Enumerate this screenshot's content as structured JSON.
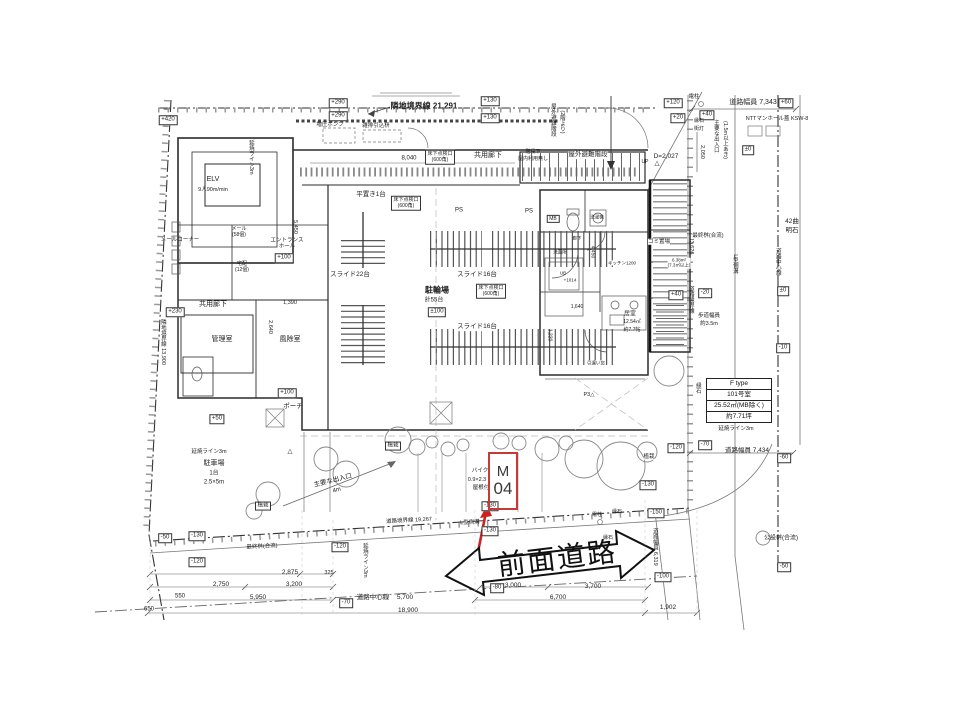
{
  "colors": {
    "marker_red": "#c73a34",
    "arrow_red": "#cc2222",
    "line_dark": "#2b2b2b"
  },
  "marker": {
    "line1": "M",
    "line2": "04"
  },
  "road": {
    "label": "前面道路"
  },
  "unit_info": {
    "rows": [
      "F type",
      "101号室",
      "25.52㎡(MB除く)",
      "約7.71坪"
    ]
  },
  "annotations": [
    {
      "t": "+420",
      "x": 168,
      "y": 120,
      "b": 1
    },
    {
      "t": "+290",
      "x": 338,
      "y": 103,
      "b": 1
    },
    {
      "t": "+290",
      "x": 338,
      "y": 116,
      "b": 1
    },
    {
      "t": "+130",
      "x": 490,
      "y": 101,
      "b": 1
    },
    {
      "t": "+130",
      "x": 490,
      "y": 118,
      "b": 1
    },
    {
      "t": "+120",
      "x": 673,
      "y": 103,
      "b": 1
    },
    {
      "t": "+20",
      "x": 678,
      "y": 118,
      "b": 1
    },
    {
      "t": "+60",
      "x": 786,
      "y": 103,
      "b": 1
    },
    {
      "t": "+40",
      "x": 707,
      "y": 115,
      "b": 1
    },
    {
      "t": "±0",
      "x": 748,
      "y": 150,
      "b": 1
    },
    {
      "t": "隣地境界線 21,291",
      "x": 424,
      "y": 106,
      "fs": 8,
      "w": 1
    },
    {
      "t": "増圧ポンプ",
      "x": 330,
      "y": 125,
      "fs": 5.5
    },
    {
      "t": "雑排引込枡",
      "x": 376,
      "y": 126,
      "fs": 5.5
    },
    {
      "t": "8,040",
      "x": 409,
      "y": 159,
      "fs": 6
    },
    {
      "t": "共用廊下",
      "x": 488,
      "y": 156,
      "fs": 7
    },
    {
      "t": "階段下",
      "x": 533,
      "y": 153,
      "fs": 5
    },
    {
      "t": "屋内利用無し",
      "x": 533,
      "y": 160,
      "fs": 5
    },
    {
      "t": "屋外避難階段",
      "x": 588,
      "y": 155,
      "fs": 6.5,
      "bg": 1
    },
    {
      "t": "屋外避難階段",
      "x": 552,
      "y": 120,
      "fs": 5.5,
      "v": 1
    },
    {
      "t": "(2階より)",
      "x": 561,
      "y": 122,
      "fs": 5.5,
      "v": 1
    },
    {
      "t": "D=2,027",
      "x": 666,
      "y": 157,
      "fs": 6.5
    },
    {
      "t": "UP",
      "x": 645,
      "y": 163,
      "fs": 5
    },
    {
      "t": "△",
      "x": 657,
      "y": 164,
      "fs": 6.5
    },
    {
      "t": "電柱",
      "x": 694,
      "y": 97,
      "fs": 5.5
    },
    {
      "t": "道路幅員 7,343",
      "x": 753,
      "y": 103,
      "fs": 7
    },
    {
      "t": "NTTマンホール蓋 KSW-8",
      "x": 777,
      "y": 119,
      "fs": 5.5
    },
    {
      "t": "縁石",
      "x": 699,
      "y": 122,
      "fs": 5
    },
    {
      "t": "街灯",
      "x": 699,
      "y": 130,
      "fs": 5
    },
    {
      "t": "2,050",
      "x": 701,
      "y": 152,
      "fs": 5.5,
      "v": 1
    },
    {
      "t": "主要な出入口",
      "x": 715,
      "y": 136,
      "fs": 5.5,
      "v": 1
    },
    {
      "t": "(1.5m以上あき)",
      "x": 724,
      "y": 140,
      "fs": 5.5,
      "v": 1
    },
    {
      "t": "±0",
      "x": 783,
      "y": 291,
      "b": 1
    },
    {
      "t": "-10",
      "x": 783,
      "y": 348,
      "b": 1
    },
    {
      "t": "-20",
      "x": 705,
      "y": 293,
      "b": 1
    },
    {
      "t": "42曲",
      "x": 792,
      "y": 222,
      "fs": 6.5
    },
    {
      "t": "明石",
      "x": 792,
      "y": 231,
      "fs": 6.5
    },
    {
      "t": "道路中心線",
      "x": 777,
      "y": 262,
      "fs": 5.5,
      "v": 1
    },
    {
      "t": "L型側溝",
      "x": 734,
      "y": 264,
      "fs": 5.5,
      "v": 1
    },
    {
      "t": "13,626",
      "x": 690,
      "y": 246,
      "fs": 5.5,
      "v": 1
    },
    {
      "t": "道路境界線",
      "x": 690,
      "y": 300,
      "fs": 5.5,
      "v": 1
    },
    {
      "t": "最終桝(合流)",
      "x": 708,
      "y": 236,
      "fs": 5.5,
      "bg": 1
    },
    {
      "t": "歩道幅員",
      "x": 709,
      "y": 316,
      "fs": 5.5
    },
    {
      "t": "約3.5m",
      "x": 709,
      "y": 324,
      "fs": 5.5
    },
    {
      "t": "縁石",
      "x": 697,
      "y": 388,
      "fs": 5.5,
      "v": 1
    },
    {
      "t": "延焼ライン3m",
      "x": 736,
      "y": 429,
      "fs": 5.5
    },
    {
      "t": "-70",
      "x": 705,
      "y": 445,
      "b": 1
    },
    {
      "t": "道路幅員 7,434",
      "x": 747,
      "y": 451,
      "fs": 6.5
    },
    {
      "t": "-60",
      "x": 784,
      "y": 458,
      "b": 1
    },
    {
      "t": "ELV",
      "x": 213,
      "y": 180,
      "fs": 7
    },
    {
      "t": "9人90m/min",
      "x": 213,
      "y": 190,
      "fs": 5.5
    },
    {
      "t": "延焼ライン3m",
      "x": 250,
      "y": 157,
      "fs": 5.5,
      "v": 1
    },
    {
      "t": "メールコーナー",
      "x": 180,
      "y": 240,
      "fs": 5.5
    },
    {
      "t": "メール\n(58個)",
      "x": 239,
      "y": 233,
      "fs": 5
    },
    {
      "t": "エントランス\nホール",
      "x": 287,
      "y": 244,
      "fs": 5.5
    },
    {
      "t": "+100",
      "x": 284,
      "y": 258,
      "b": 1
    },
    {
      "t": "宅配\n(12個)",
      "x": 242,
      "y": 268,
      "fs": 5
    },
    {
      "t": "5,450",
      "x": 294,
      "y": 227,
      "fs": 5.5,
      "v": 1
    },
    {
      "t": "共用廊下",
      "x": 213,
      "y": 305,
      "fs": 7
    },
    {
      "t": "隣地境界線 13,900",
      "x": 162,
      "y": 342,
      "fs": 5.5,
      "v": 1
    },
    {
      "t": "+230",
      "x": 175,
      "y": 312,
      "b": 1
    },
    {
      "t": "管理室",
      "x": 222,
      "y": 340,
      "fs": 7
    },
    {
      "t": "風除室",
      "x": 290,
      "y": 340,
      "fs": 7
    },
    {
      "t": "1,390",
      "x": 290,
      "y": 303,
      "fs": 5.5
    },
    {
      "t": "2,640",
      "x": 269,
      "y": 327,
      "fs": 5.5,
      "v": 1
    },
    {
      "t": "+100",
      "x": 287,
      "y": 393,
      "b": 1
    },
    {
      "t": "ポーチ",
      "x": 293,
      "y": 407,
      "fs": 6.5
    },
    {
      "t": "+50",
      "x": 217,
      "y": 419,
      "b": 1
    },
    {
      "t": "平置き1台",
      "x": 371,
      "y": 195,
      "fs": 6.5
    },
    {
      "t": "床下点検口\n(600角)",
      "x": 440,
      "y": 157,
      "fs": 5,
      "b": 1
    },
    {
      "t": "床下点検口\n(600角)",
      "x": 406,
      "y": 203,
      "fs": 5,
      "b": 1
    },
    {
      "t": "床下点検口\n(600角)",
      "x": 491,
      "y": 291,
      "fs": 5,
      "b": 1
    },
    {
      "t": "PS",
      "x": 459,
      "y": 211,
      "fs": 6
    },
    {
      "t": "PS",
      "x": 529,
      "y": 212,
      "fs": 6
    },
    {
      "t": "MB",
      "x": 553,
      "y": 219,
      "fs": 5,
      "b": 1
    },
    {
      "t": "スライド22台",
      "x": 350,
      "y": 275,
      "fs": 6.5,
      "bg": 1
    },
    {
      "t": "スライド16台",
      "x": 477,
      "y": 275,
      "fs": 6.5,
      "bg": 1
    },
    {
      "t": "スライド16台",
      "x": 477,
      "y": 327,
      "fs": 6.5,
      "bg": 1
    },
    {
      "t": "駐輪場",
      "x": 437,
      "y": 290,
      "fs": 8,
      "w": 1
    },
    {
      "t": "計55台",
      "x": 434,
      "y": 301,
      "fs": 6
    },
    {
      "t": "±100",
      "x": 437,
      "y": 312,
      "b": 1
    },
    {
      "t": "洗濯機",
      "x": 597,
      "y": 217,
      "fs": 4.5
    },
    {
      "t": "洗面所",
      "x": 560,
      "y": 252,
      "fs": 4.5
    },
    {
      "t": "廊下",
      "x": 577,
      "y": 238,
      "fs": 4.5
    },
    {
      "t": "UB",
      "x": 563,
      "y": 273,
      "fs": 4.5
    },
    {
      "t": "+1014",
      "x": 570,
      "y": 280,
      "fs": 4.5
    },
    {
      "t": "キッチン1200",
      "x": 622,
      "y": 263,
      "fs": 4.5,
      "bg": 1
    },
    {
      "t": "居室",
      "x": 630,
      "y": 315,
      "fs": 6
    },
    {
      "t": "12.54㎡",
      "x": 632,
      "y": 323,
      "fs": 5
    },
    {
      "t": "約7.7帖",
      "x": 632,
      "y": 331,
      "fs": 5
    },
    {
      "t": "1,640",
      "x": 577,
      "y": 308,
      "fs": 5
    },
    {
      "t": "1,220",
      "x": 549,
      "y": 335,
      "fs": 5,
      "v": 1
    },
    {
      "t": "4,450",
      "x": 592,
      "y": 252,
      "fs": 5,
      "v": 1
    },
    {
      "t": "引違い窓",
      "x": 596,
      "y": 363,
      "fs": 4.5,
      "bg": 1
    },
    {
      "t": "ゴミ置場",
      "x": 659,
      "y": 242,
      "fs": 5.5,
      "bg": 1
    },
    {
      "t": "6.38m²\n(7.3㎡以上)",
      "x": 679,
      "y": 263,
      "fs": 4.5,
      "bg": 1
    },
    {
      "t": "+40",
      "x": 676,
      "y": 295,
      "b": 1
    },
    {
      "t": "P3△",
      "x": 589,
      "y": 395,
      "fs": 5.5
    },
    {
      "t": "植栽",
      "x": 263,
      "y": 506,
      "fs": 5.5,
      "b": 1
    },
    {
      "t": "植栽",
      "x": 393,
      "y": 446,
      "fs": 5.5,
      "b": 1
    },
    {
      "t": "植栽",
      "x": 649,
      "y": 457,
      "fs": 5.5,
      "bg": 1
    },
    {
      "t": "駐車場",
      "x": 214,
      "y": 464,
      "fs": 7
    },
    {
      "t": "1台",
      "x": 214,
      "y": 474,
      "fs": 6
    },
    {
      "t": "2.5×5m",
      "x": 214,
      "y": 483,
      "fs": 6
    },
    {
      "t": "延焼ライン3m",
      "x": 209,
      "y": 452,
      "fs": 5.5
    },
    {
      "t": "主要な出入口",
      "x": 333,
      "y": 481,
      "fs": 6.5,
      "r": -14
    },
    {
      "t": "4m",
      "x": 337,
      "y": 491,
      "fs": 6,
      "r": -14
    },
    {
      "t": "△",
      "x": 290,
      "y": 452,
      "fs": 6.5
    },
    {
      "t": "バイク",
      "x": 480,
      "y": 471,
      "fs": 5.5
    },
    {
      "t": "0.9×2.3",
      "x": 477,
      "y": 480,
      "fs": 5.5
    },
    {
      "t": "屋根付",
      "x": 481,
      "y": 488,
      "fs": 5.5
    },
    {
      "t": "-130",
      "x": 490,
      "y": 506,
      "b": 1
    },
    {
      "t": "-130",
      "x": 490,
      "y": 531,
      "b": 1
    },
    {
      "t": "-130",
      "x": 648,
      "y": 485,
      "b": 1
    },
    {
      "t": "-120",
      "x": 676,
      "y": 448,
      "b": 1
    },
    {
      "t": "-130",
      "x": 197,
      "y": 536,
      "b": 1
    },
    {
      "t": "-50",
      "x": 165,
      "y": 538,
      "b": 1
    },
    {
      "t": "-120",
      "x": 197,
      "y": 562,
      "b": 1
    },
    {
      "t": "道路境界線 19,267",
      "x": 409,
      "y": 521,
      "fs": 5.5,
      "r": -3
    },
    {
      "t": "L型側溝",
      "x": 470,
      "y": 523,
      "fs": 5.5,
      "r": -3
    },
    {
      "t": "電柱",
      "x": 597,
      "y": 516,
      "fs": 5
    },
    {
      "t": "縁石",
      "x": 617,
      "y": 513,
      "fs": 5
    },
    {
      "t": "縁石",
      "x": 608,
      "y": 539,
      "fs": 5
    },
    {
      "t": "最終桝(合流)",
      "x": 262,
      "y": 547,
      "fs": 5.5,
      "r": -3
    },
    {
      "t": "公設桝(合流)",
      "x": 781,
      "y": 539,
      "fs": 6
    },
    {
      "t": "-50",
      "x": 784,
      "y": 567,
      "b": 1
    },
    {
      "t": "-150",
      "x": 656,
      "y": 513,
      "b": 1
    },
    {
      "t": "-100",
      "x": 663,
      "y": 577,
      "b": 1
    },
    {
      "t": "道路幅員 6,319",
      "x": 654,
      "y": 547,
      "fs": 5.5,
      "v": 1
    },
    {
      "t": "1,902",
      "x": 668,
      "y": 608,
      "fs": 6.5
    },
    {
      "t": "550",
      "x": 180,
      "y": 597,
      "fs": 6
    },
    {
      "t": "650",
      "x": 149,
      "y": 610,
      "fs": 6
    },
    {
      "t": "2,750",
      "x": 221,
      "y": 585,
      "fs": 6.5
    },
    {
      "t": "5,950",
      "x": 258,
      "y": 598,
      "fs": 6.5
    },
    {
      "t": "2,875",
      "x": 290,
      "y": 573,
      "fs": 6.5
    },
    {
      "t": "3,200",
      "x": 294,
      "y": 585,
      "fs": 6.5
    },
    {
      "t": "325",
      "x": 329,
      "y": 573,
      "fs": 5.5
    },
    {
      "t": "-70",
      "x": 346,
      "y": 603,
      "b": 1
    },
    {
      "t": "道路中心線",
      "x": 373,
      "y": 598,
      "fs": 6.5
    },
    {
      "t": "5,700",
      "x": 405,
      "y": 598,
      "fs": 6.5
    },
    {
      "t": "18,900",
      "x": 408,
      "y": 611,
      "fs": 6.5
    },
    {
      "t": "-120",
      "x": 340,
      "y": 547,
      "b": 1
    },
    {
      "t": "延焼ライン3m",
      "x": 364,
      "y": 560,
      "fs": 5.5,
      "v": 1
    },
    {
      "t": "-80",
      "x": 497,
      "y": 588,
      "b": 1
    },
    {
      "t": "3,000",
      "x": 513,
      "y": 586,
      "fs": 6.5
    },
    {
      "t": "6,700",
      "x": 558,
      "y": 598,
      "fs": 6.5
    },
    {
      "t": "3,700",
      "x": 593,
      "y": 587,
      "fs": 6.5
    }
  ]
}
